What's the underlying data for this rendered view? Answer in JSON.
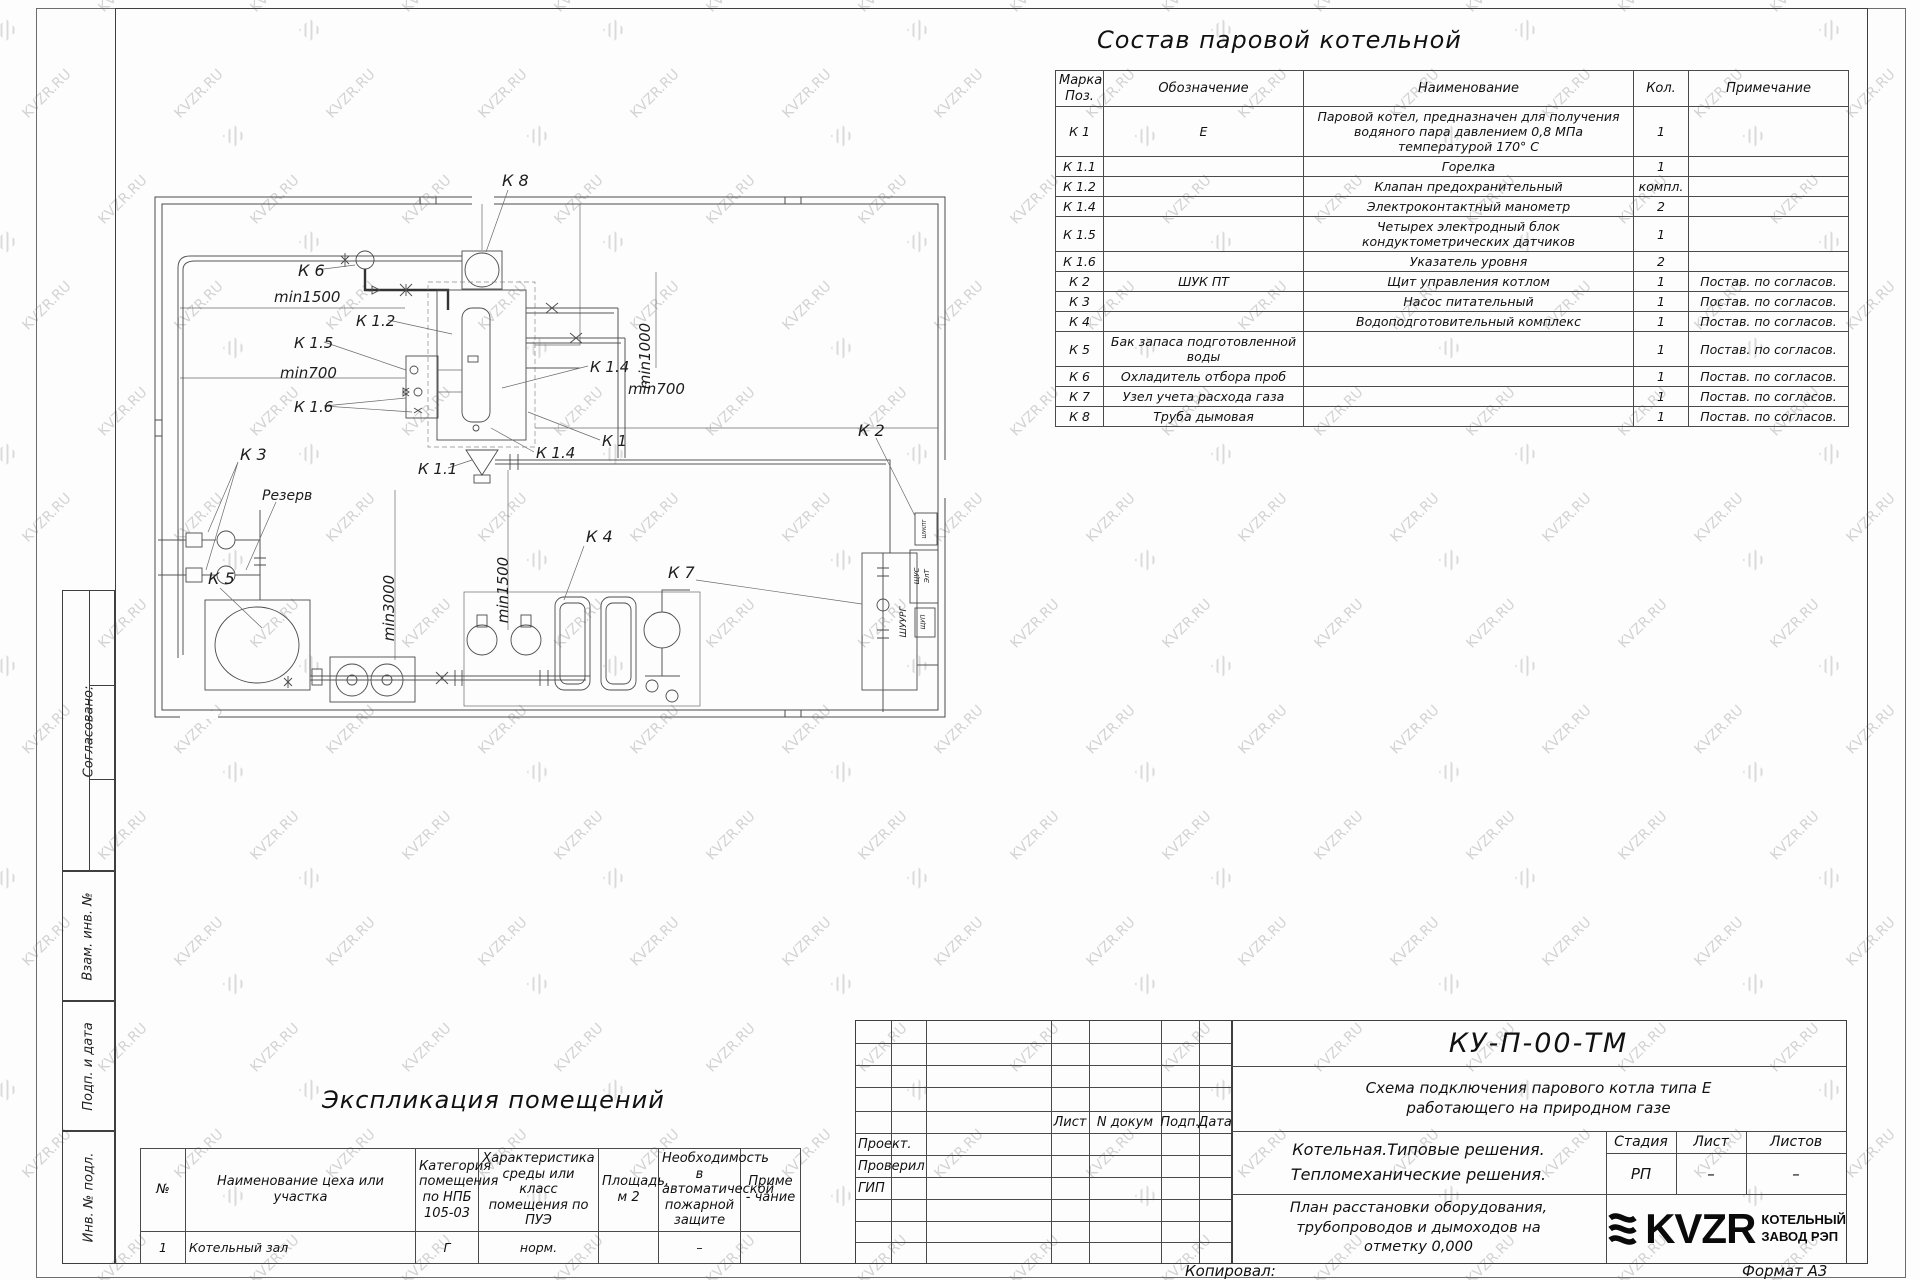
{
  "watermark": {
    "text": "KVZR.RU"
  },
  "equipment_table": {
    "title": "Состав паровой котельной",
    "headers": [
      "Марка Поз.",
      "Обозначение",
      "Наименование",
      "Кол.",
      "Примечание"
    ],
    "rows": [
      {
        "mark": "К 1",
        "designation": "Е",
        "name": "Паровой котел, предназначен для получения водяного пара давлением  0,8  МПа температурой  170° С",
        "qty": "1",
        "note": ""
      },
      {
        "mark": "К 1.1",
        "designation": "",
        "name": "Горелка",
        "qty": "1",
        "note": ""
      },
      {
        "mark": "К 1.2",
        "designation": "",
        "name": "Клапан предохранительный",
        "qty": "компл.",
        "note": ""
      },
      {
        "mark": "К 1.4",
        "designation": "",
        "name": "Электроконтактный манометр",
        "qty": "2",
        "note": ""
      },
      {
        "mark": "К 1.5",
        "designation": "",
        "name": "Четырех электродный блок кондуктометрических датчиков",
        "qty": "1",
        "note": ""
      },
      {
        "mark": "К 1.6",
        "designation": "",
        "name": "Указатель уровня",
        "qty": "2",
        "note": ""
      },
      {
        "mark": "К 2",
        "designation": "ШУК ПТ",
        "name": "Щит управления котлом",
        "qty": "1",
        "note": "Постав. по согласов."
      },
      {
        "mark": "К 3",
        "designation": "",
        "name": "Насос питательный",
        "qty": "1",
        "note": "Постав. по согласов."
      },
      {
        "mark": "К 4",
        "designation": "",
        "name": "Водоподготовительный комплекс",
        "qty": "1",
        "note": "Постав. по согласов."
      },
      {
        "mark": "К 5",
        "designation": "Бак запаса подготовленной воды",
        "name": "",
        "qty": "1",
        "note": "Постав. по согласов."
      },
      {
        "mark": "К 6",
        "designation": "Охладитель отбора проб",
        "name": "",
        "qty": "1",
        "note": "Постав. по согласов."
      },
      {
        "mark": "К 7",
        "designation": "Узел учета расхода газа",
        "name": "",
        "qty": "1",
        "note": "Постав. по согласов."
      },
      {
        "mark": "К 8",
        "designation": "Труба дымовая",
        "name": "",
        "qty": "1",
        "note": "Постав. по согласов."
      }
    ]
  },
  "explication_table": {
    "title": "Экспликация помещений",
    "headers": [
      "№",
      "Наименование цеха или участка",
      "Категория помещения по НПБ 105-03",
      "Характеристика среды или класс помещения по ПУЭ",
      "Площадь, м 2",
      "Необходимость в автоматической пожарной защите",
      "Приме - чание"
    ],
    "rows": [
      {
        "num": "1",
        "name": "Котельный зал",
        "category": "Г",
        "environment": "норм.",
        "area": "",
        "fire": "–",
        "note": ""
      }
    ]
  },
  "plan": {
    "labels": [
      {
        "text": "К 8",
        "x": 352,
        "y": 26,
        "r": 0,
        "s": 16
      },
      {
        "text": "К 6",
        "x": 148,
        "y": 116,
        "r": 0,
        "s": 16
      },
      {
        "text": "min1500",
        "x": 124,
        "y": 142,
        "r": 0,
        "s": 15
      },
      {
        "text": "К 1.2",
        "x": 206,
        "y": 166,
        "r": 0,
        "s": 15
      },
      {
        "text": "К 1.5",
        "x": 144,
        "y": 188,
        "r": 0,
        "s": 15
      },
      {
        "text": "min700",
        "x": 130,
        "y": 218,
        "r": 0,
        "s": 15
      },
      {
        "text": "К 1.6",
        "x": 144,
        "y": 252,
        "r": 0,
        "s": 15
      },
      {
        "text": "К 1.4",
        "x": 440,
        "y": 212,
        "r": 0,
        "s": 15
      },
      {
        "text": "min1000",
        "x": 500,
        "y": 196,
        "r": -90,
        "s": 15
      },
      {
        "text": "min700",
        "x": 478,
        "y": 234,
        "r": 0,
        "s": 15
      },
      {
        "text": "К 1",
        "x": 452,
        "y": 286,
        "r": 0,
        "s": 15
      },
      {
        "text": "К 1.4",
        "x": 386,
        "y": 298,
        "r": 0,
        "s": 15
      },
      {
        "text": "К 1.1",
        "x": 268,
        "y": 314,
        "r": 0,
        "s": 15
      },
      {
        "text": "К 2",
        "x": 708,
        "y": 276,
        "r": 0,
        "s": 16
      },
      {
        "text": "К 3",
        "x": 90,
        "y": 300,
        "r": 0,
        "s": 16
      },
      {
        "text": "Резерв",
        "x": 112,
        "y": 340,
        "r": 0,
        "s": 14
      },
      {
        "text": "min3000",
        "x": 244,
        "y": 448,
        "r": -90,
        "s": 15
      },
      {
        "text": "min1500",
        "x": 358,
        "y": 430,
        "r": -90,
        "s": 15
      },
      {
        "text": "К 4",
        "x": 436,
        "y": 382,
        "r": 0,
        "s": 16
      },
      {
        "text": "К 5",
        "x": 58,
        "y": 424,
        "r": 0,
        "s": 16
      },
      {
        "text": "К 7",
        "x": 518,
        "y": 418,
        "r": 0,
        "s": 16
      }
    ],
    "cabinets": [
      {
        "text": "ШУКПТ",
        "x": 776,
        "y": 369,
        "r": -90,
        "s": 5
      },
      {
        "text": "ЩУС",
        "x": 769,
        "y": 416,
        "r": -90,
        "s": 7
      },
      {
        "text": "ЭлТ",
        "x": 779,
        "y": 416,
        "r": -90,
        "s": 7
      },
      {
        "text": "ЩУП",
        "x": 775,
        "y": 462,
        "r": -90,
        "s": 6
      },
      {
        "text": "ШУУРГ",
        "x": 756,
        "y": 462,
        "r": -90,
        "s": 9
      }
    ]
  },
  "title_block": {
    "doc_number": "КУ-П-00-ТМ",
    "subtitle_lines": [
      "Схема подключения парового котла типа Е",
      "работающего на природном газе"
    ],
    "project_lines": [
      "Котельная.Типовые решения.",
      "Тепломеханические решения."
    ],
    "caption_lines": [
      "План расстановки оборудования,",
      "трубопроводов и дымоходов на",
      "отметку  0,000"
    ],
    "row_header": [
      "Лист",
      "N докум",
      "Подп.",
      "Дата"
    ],
    "roles": [
      "Проект.",
      "Проверил",
      "ГИП"
    ],
    "stage_header": [
      "Стадия",
      "Лист",
      "Листов"
    ],
    "stage_values": [
      "РП",
      "–",
      "–"
    ],
    "logo_text": "KVZR",
    "logo_caption_lines": [
      "КОТЕЛЬНЫЙ",
      "ЗАВОД РЭП"
    ],
    "copied_label": "Копировал:",
    "format_label": "Формат А3"
  },
  "side_labels": [
    "Согласовано:",
    "Взам. инв. №",
    "Подп. и дата",
    "Инв. № подл."
  ]
}
